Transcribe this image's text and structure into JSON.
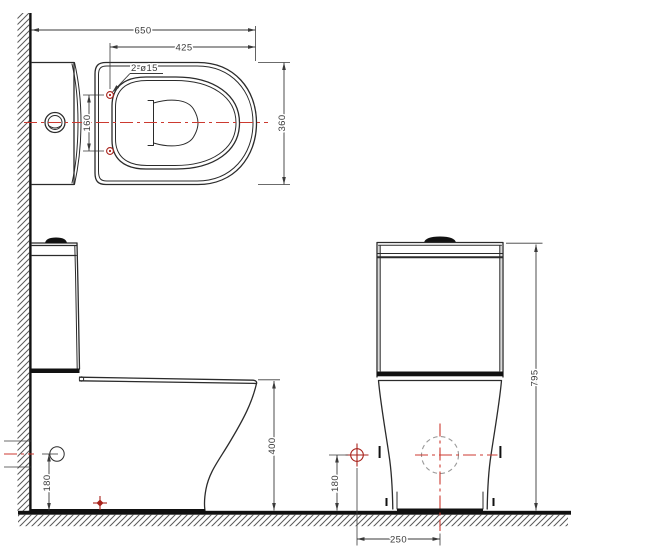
{
  "drawing": {
    "title": "toilet-three-view-technical-drawing",
    "views": {
      "top": "top-plan-view",
      "side": "side-elevation-view",
      "front": "front-elevation-view"
    },
    "labels": {
      "dim_overall_depth": "650",
      "dim_holes_to_front": "425",
      "note_seat_holes": "2-ø15",
      "dim_hole_spacing": "160",
      "dim_bowl_width": "360",
      "dim_seat_height": "400",
      "dim_inlet_height_side": "180",
      "dim_inlet_height_front": "180",
      "dim_inlet_offset": "250",
      "dim_total_height": "795"
    },
    "colors": {
      "paper": "#ffffff",
      "line": "#2b2b2b",
      "dim": "#3a3a3a",
      "centerline": "#cc3a30",
      "marker": "#a8221b",
      "hatch": "#5a5a5a",
      "hidden": "#999999",
      "fill-dark": "#111111"
    }
  }
}
